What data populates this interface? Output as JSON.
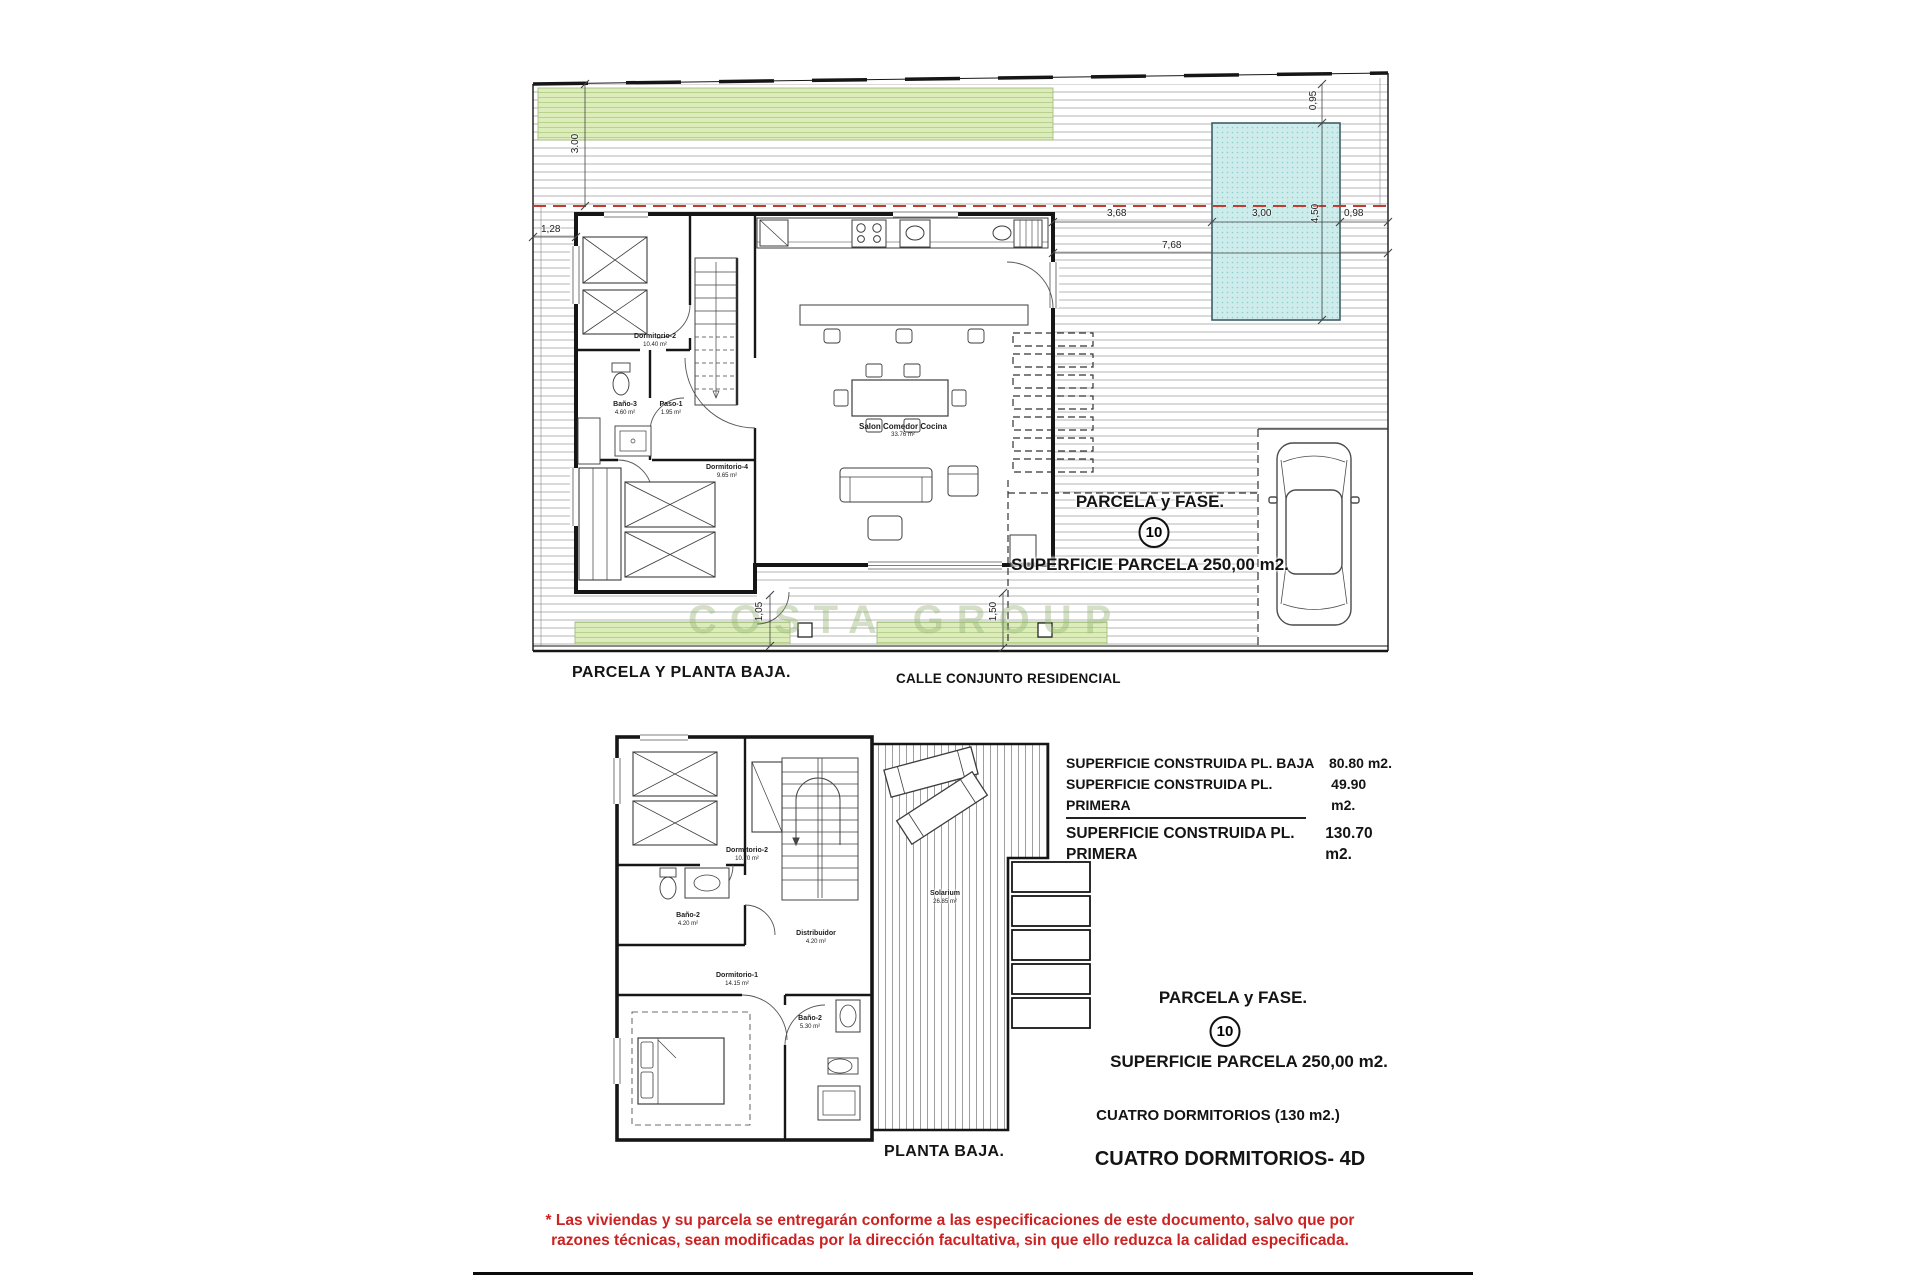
{
  "watermark": {
    "text": "COSTA GROUP"
  },
  "colors": {
    "accent_red": "#c23b33",
    "pool": "#cdeceb",
    "grass": "#dcedbb",
    "disclaimer_red": "#cc2222"
  },
  "top_plan": {
    "title": "PARCELA Y PLANTA BAJA.",
    "street_label": "CALLE CONJUNTO RESIDENCIAL",
    "parcel_label": "PARCELA y FASE.",
    "parcel_number": "10",
    "parcel_area": "SUPERFICIE PARCELA 250,00 m2.",
    "rooms": [
      {
        "name": "Dormitorio-2",
        "area": "10.40 m²"
      },
      {
        "name": "Baño-3",
        "area": "4.60 m²"
      },
      {
        "name": "Paso-1",
        "area": "1.95 m²"
      },
      {
        "name": "Dormitorio-4",
        "area": "9.65 m²"
      },
      {
        "name": "Salon Comedor Cocina",
        "area": "33.76 m²"
      }
    ],
    "dimensions": {
      "front_depth": "3.00",
      "side_left": "1,28",
      "pool_offset": "0,95",
      "pool_length": "4,50",
      "house_to_pool": "3,68",
      "pool_width": "3,00",
      "pool_to_edge": "0,98",
      "right_total": "7,68",
      "back_left": "1,05",
      "back_right": "1,50"
    }
  },
  "lower_plan": {
    "title": "PLANTA BAJA.",
    "rooms": [
      {
        "name": "Dormitorio-2",
        "area": "10.70 m²"
      },
      {
        "name": "Baño-2",
        "area": "4.20 m²"
      },
      {
        "name": "Distribuidor",
        "area": "4.20 m²"
      },
      {
        "name": "Dormitorio-1",
        "area": "14.15 m²"
      },
      {
        "name": "Baño-2",
        "area": "5.30 m²"
      },
      {
        "name": "Solarium",
        "area": "26.85 m²"
      }
    ]
  },
  "summary": {
    "rows": [
      {
        "label": "SUPERFICIE CONSTRUIDA PL. BAJA",
        "value": "80.80 m2."
      },
      {
        "label": "SUPERFICIE CONSTRUIDA PL. PRIMERA",
        "value": "49.90 m2."
      },
      {
        "label": "SUPERFICIE CONSTRUIDA PL. PRIMERA",
        "value": "130.70  m2."
      }
    ]
  },
  "info": {
    "parcel_label": "PARCELA y FASE.",
    "parcel_number": "10",
    "parcel_area": "SUPERFICIE PARCELA 250,00 m2.",
    "bedrooms_line": "CUATRO DORMITORIOS (130 m2.)",
    "model_line": "CUATRO DORMITORIOS- 4D"
  },
  "disclaimer": {
    "line1": "* Las viviendas y su parcela se entregarán conforme a las especificaciones de este documento, salvo que por",
    "line2": "razones técnicas, sean modificadas por la dirección facultativa, sin que ello reduzca la calidad especificada."
  }
}
